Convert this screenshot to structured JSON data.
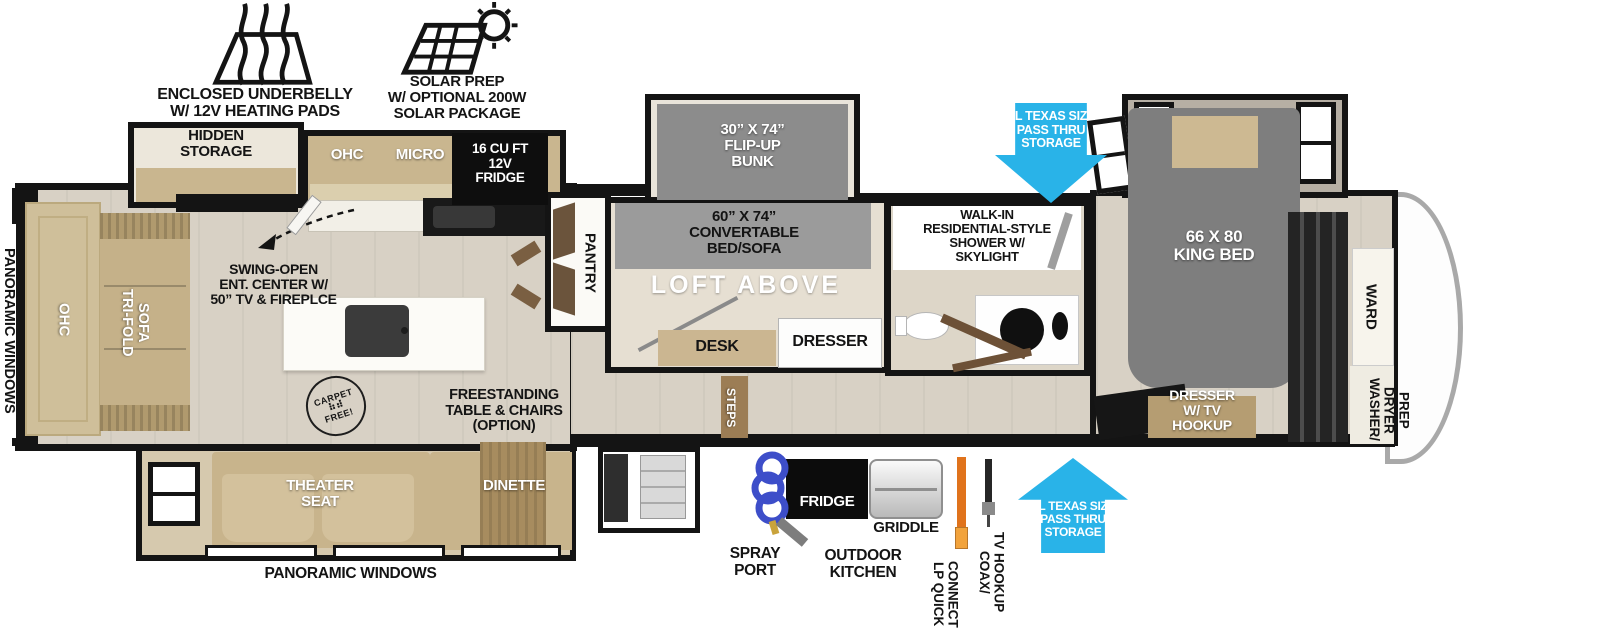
{
  "exterior": {
    "underbelly": "ENCLOSED UNDERBELLY\nW/ 12V HEATING PADS",
    "solar": "SOLAR PREP\nW/ OPTIONAL 200W\nSOLAR PACKAGE",
    "panoramic_left": "PANORAMIC WINDOWS",
    "panoramic_bottom": "PANORAMIC WINDOWS",
    "pass_thru_top": "XL TEXAS SIZE\nPASS THRU\nSTORAGE",
    "pass_thru_bottom": "XL TEXAS SIZE\nPASS THRU\nSTORAGE"
  },
  "living_area": {
    "hidden_storage": "HIDDEN\nSTORAGE",
    "ohc": "OHC",
    "micro": "MICRO",
    "fridge": "16 CU FT\n12V\nFRIDGE",
    "pantry": "PANTRY",
    "ent_center": "SWING-OPEN\nENT. CENTER W/\n50” TV & FIREPLCE",
    "rear_ohc": "OHC",
    "sofa": "TRI-FOLD\nSOFA",
    "carpet_stamp_top": "CARPET",
    "carpet_stamp_paws": "⠷⠾",
    "carpet_stamp_bottom": "FREE!",
    "table_option": "FREESTANDING\nTABLE & CHAIRS\n(OPTION)",
    "theater": "THEATER\nSEAT",
    "dinette": "DINETTE"
  },
  "loft_room": {
    "bunk": "30” X 74”\nFLIP-UP\nBUNK",
    "convertable": "60” X 74”\nCONVERTABLE\nBED/SOFA",
    "loft": "LOFT ABOVE",
    "desk": "DESK",
    "dresser": "DRESSER",
    "steps": "STEPS"
  },
  "bathroom": {
    "shower": "WALK-IN\nRESIDENTIAL-STYLE\nSHOWER W/\nSKYLIGHT"
  },
  "bedroom": {
    "bed": "66 X 80\nKING BED",
    "dresser_tv": "DRESSER\nW/ TV\nHOOKUP",
    "ward": "WARD",
    "washer_dryer": "WASHER/\nDRYER\nPREP"
  },
  "utilities": {
    "spray_port": "SPRAY\nPORT",
    "outdoor_kitchen": "OUTDOOR\nKITCHEN",
    "fridge": "FRIDGE",
    "griddle": "GRIDDLE",
    "lp": "LP QUICK\nCONNECT",
    "coax": "COAX/\nTV HOOKUP"
  },
  "colors": {
    "wall": "#141414",
    "floor": "#d8d1c5",
    "cabinet_tan": "#c9b68f",
    "bed_gray": "#7e7e7e",
    "arrow_blue": "#29b3e8",
    "lp_orange": "#e0731c",
    "coil_blue": "#3d4ec9",
    "step_brown": "#9c7d55"
  }
}
